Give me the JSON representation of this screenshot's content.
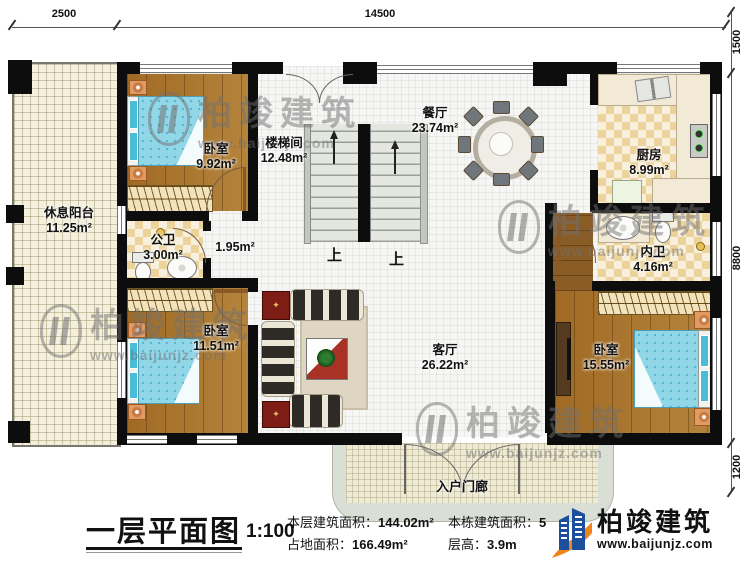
{
  "plan": {
    "title": "一层平面图",
    "scale": "1:100"
  },
  "dimensions": {
    "top": [
      "2500",
      "14500"
    ],
    "right": [
      "1500",
      "8800",
      "1200"
    ]
  },
  "rooms": [
    {
      "name": "休息阳台",
      "area": "11.25m²"
    },
    {
      "name": "卧室",
      "area": "9.92m²"
    },
    {
      "name": "楼梯间",
      "area": "12.48m²"
    },
    {
      "name": "餐厅",
      "area": "23.74m²"
    },
    {
      "name": "厨房",
      "area": "8.99m²"
    },
    {
      "name": "公卫",
      "area": "3.00m²"
    },
    {
      "name": "",
      "area": "1.95m²"
    },
    {
      "name": "内卫",
      "area": "4.16m²"
    },
    {
      "name": "卧室",
      "area": "11.51m²"
    },
    {
      "name": "客厅",
      "area": "26.22m²"
    },
    {
      "name": "卧室",
      "area": "15.55m²"
    },
    {
      "name": "入户门廊",
      "area": ""
    }
  ],
  "stairs": {
    "up_label": "上"
  },
  "titleblock": {
    "title": "一层平面图",
    "scale": "1:100",
    "floor_area_label": "本层建筑面积：",
    "floor_area_value": "144.02m²",
    "land_area_label": "占地面积：",
    "land_area_value": "166.49m²",
    "total_area_label": "本栋建筑面积：",
    "total_area_value": "5",
    "storey_height_label": "层高：",
    "storey_height_value": "3.9m"
  },
  "branding": {
    "name": "柏竣建筑",
    "website": "www.baijunjz.com"
  },
  "watermark": {
    "name": "柏竣建筑",
    "website": "www.baijunjz.com"
  },
  "colors": {
    "wall": "#0d0d0d",
    "wood_floor": "#a9752c",
    "bed_blue": "#92d7e8",
    "logo_blue": "#1c4f9c",
    "logo_orange": "#f08419"
  }
}
